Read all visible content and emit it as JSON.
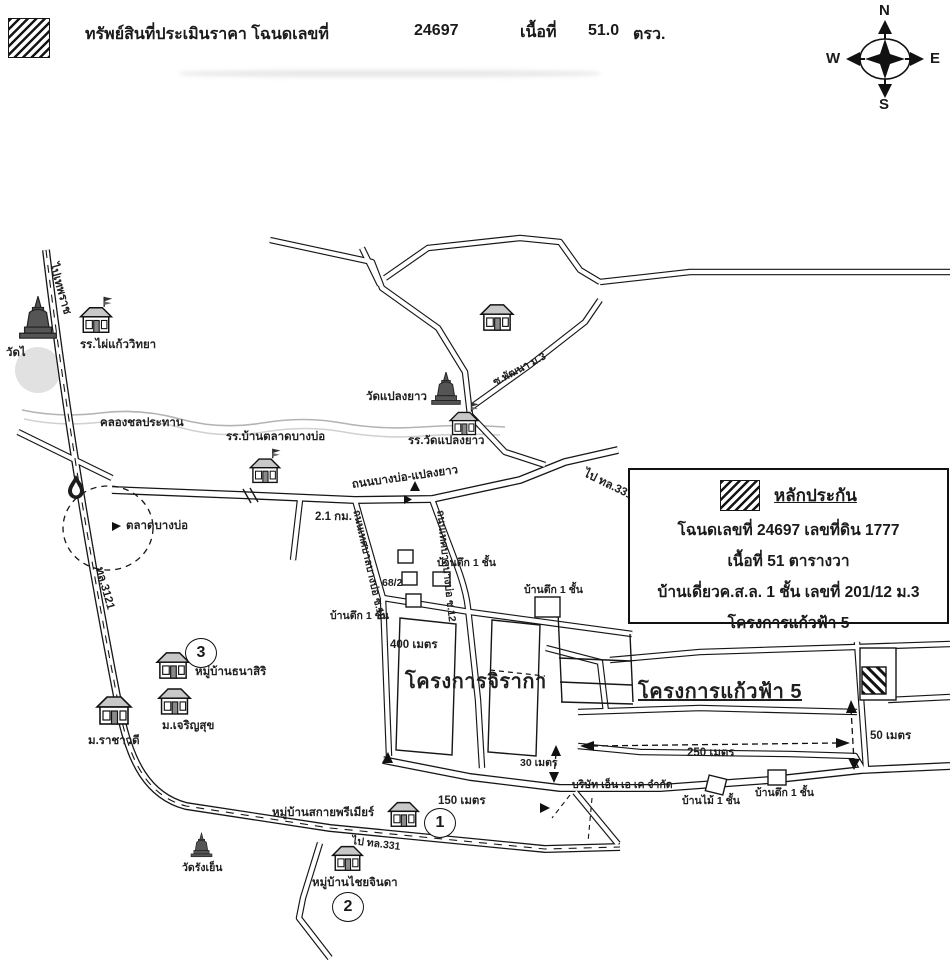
{
  "header": {
    "title": "ทรัพย์สินที่ประเมินราคา โฉนดเลขที่",
    "deed_no": "24697",
    "area_label": "เนื้อที่",
    "area_value": "51.0",
    "area_unit": "ตรว."
  },
  "compass": {
    "n": "N",
    "s": "S",
    "w": "W",
    "e": "E"
  },
  "legend": {
    "title": "หลักประกัน",
    "line1": "โฉนดเลขที่ 24697  เลขที่ดิน 1777",
    "line2": "เนื้อที่ 51 ตารางวา",
    "line3": "บ้านเดี่ยวค.ส.ล. 1 ชั้น เลขที่ 201/12 ม.3",
    "line4": "โครงการแก้วฟ้า 5"
  },
  "map": {
    "labels": {
      "wat_left": "วัดไ",
      "school_phaikaew": "รร.ไผ่แก้ววิทยา",
      "canal": "คลองชลประทาน",
      "market": "ตลาดบางบ่อ",
      "hw3121": "ทล.3121",
      "to_north": "ไปเทพราช",
      "school_bantalad": "รร.บ้านตลาดบางบ่อ",
      "wat_plaengyao": "วัดแปลงยาว",
      "school_watplaengyao": "รร.วัดแปลงยาว",
      "rd_main": "ถนนบางบ่อ-แปลงยาว",
      "to_hw331": "ไป ทล.331",
      "km21": "2.1 กม.",
      "soi10": "ถนนเทศบาลบางบ่อ ซ.10",
      "soi12": "ถนนเทศบาลบางบ่อ ซ.12",
      "soi_pattana": "ซ.พัฒนา ม.3",
      "bldg1": "บ้านตึก 1 ชั้น",
      "no682": "68/2",
      "m400": "400 เมตร",
      "jiraka": "โครงการจิรากา",
      "kaewfa": "โครงการแก้วฟ้า 5",
      "m250": "250 เมตร",
      "m50": "50 เมตร",
      "m30": "30 เมตร",
      "company": "บริษัท เอ็น เอ เค จำกัด",
      "wood_house": "บ้านไม้ 1 ชั้น",
      "m150": "150 เมตร",
      "thanasiri": "หมู่บ้านธนาสิริ",
      "rachawadee": "ม.ราชาวดี",
      "charoensuk": "ม.เจริญสุข",
      "sky_premier": "หมู่บ้านสกายพรีเมียร์",
      "wat_rangyen": "วัดรังเย็น",
      "chaijinda": "หมู่บ้านไชยจินดา"
    },
    "circled_markers": {
      "one": "1",
      "two": "2",
      "three": "3"
    }
  },
  "colors": {
    "ink": "#1a1a1a",
    "paper": "#ffffff",
    "building_gray": "#c8c8c8",
    "temple_gray": "#555555"
  }
}
